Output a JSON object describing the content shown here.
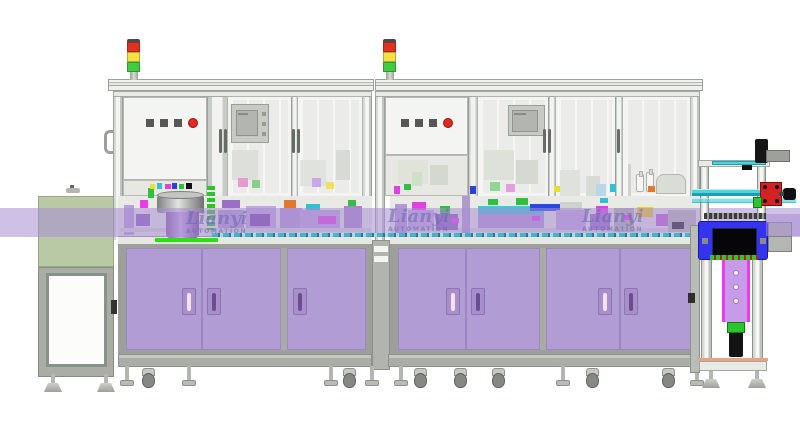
{
  "title": "Automated assembly line - CAD side view",
  "watermark": {
    "brand": "Lianyi",
    "sub": "AUTOMATION",
    "instances": [
      {
        "x": 186,
        "y": 210
      },
      {
        "x": 388,
        "y": 208
      },
      {
        "x": 582,
        "y": 208
      }
    ]
  },
  "signal_towers": {
    "positions": [
      127,
      383
    ],
    "segments": [
      "red",
      "yellow",
      "green"
    ]
  },
  "control_panels": [
    {
      "squares_x": [
        146,
        160,
        174
      ],
      "round_x": 188,
      "y": 119
    },
    {
      "squares_x": [
        401,
        415,
        429
      ],
      "round_x": 443,
      "y": 119
    }
  ],
  "colors": {
    "frame-mid": "#ced1cb",
    "panel": "#f4f5f2",
    "glass": "#ebece9",
    "table": "#e9eae5",
    "cabinet": "#b19cd3",
    "cabinet-seam": "#9d86c2",
    "cabinet-border": "#9d9f9a",
    "handle-dark": "#6b4e92",
    "handle-light": "#f2e3fa",
    "base": "#abaea7",
    "band": "rgba(168,140,210,0.55)",
    "green-box": "#b9c9a6",
    "body-gray": "#a9ada6",
    "door-white": "#fcfcfb",
    "tower-red": "#e0301e",
    "tower-yellow": "#f2e143",
    "tower-green": "#41cb41",
    "btn-red": "#e5271e",
    "btn-dark": "#575757",
    "hmi": "#c8cac5",
    "hmi-screen": "#b3b6b0",
    "blue": "#3434ee",
    "teal": "#4fd4da",
    "teal-dark": "#1b9fb4",
    "col-purple": "#c89be8",
    "magenta": "#ea3cea",
    "bright-green": "#2edf12",
    "red-unit": "#d32222",
    "wm": "rgba(100,100,170,0.52)"
  },
  "band_blocks": [
    [
      124,
      205,
      10,
      30,
      "#b9a0d8"
    ],
    [
      136,
      214,
      14,
      12,
      "#8f5fc0"
    ],
    [
      140,
      200,
      8,
      8,
      "#ea3cea"
    ],
    [
      148,
      188,
      6,
      10,
      "#30c040"
    ],
    [
      150,
      184,
      5,
      5,
      "#e8e030"
    ],
    [
      157,
      183,
      5,
      6,
      "#30c0d0"
    ],
    [
      165,
      184,
      6,
      5,
      "#e040e0"
    ],
    [
      172,
      183,
      5,
      6,
      "#3040e0"
    ],
    [
      179,
      184,
      5,
      5,
      "#30c040"
    ],
    [
      186,
      183,
      6,
      6,
      "#111111"
    ],
    [
      218,
      210,
      26,
      22,
      "#b49ad4"
    ],
    [
      222,
      200,
      18,
      8,
      "#9a6fc8"
    ],
    [
      232,
      150,
      26,
      30,
      "#dde0da"
    ],
    [
      238,
      178,
      10,
      9,
      "#e89ad0"
    ],
    [
      252,
      180,
      8,
      8,
      "#88d088"
    ],
    [
      246,
      206,
      30,
      26,
      "#c0a8e0"
    ],
    [
      250,
      214,
      20,
      12,
      "#7848a8"
    ],
    [
      280,
      208,
      22,
      24,
      "#b49ad4"
    ],
    [
      284,
      200,
      12,
      8,
      "#e07830"
    ],
    [
      300,
      160,
      26,
      26,
      "#e0e2dd"
    ],
    [
      336,
      150,
      14,
      30,
      "#d8dbd5"
    ],
    [
      312,
      178,
      9,
      9,
      "#c8a8e8"
    ],
    [
      326,
      182,
      8,
      7,
      "#f0e060"
    ],
    [
      300,
      210,
      40,
      20,
      "#bfa6de"
    ],
    [
      306,
      204,
      14,
      6,
      "#30c0d0"
    ],
    [
      318,
      216,
      18,
      8,
      "#e040e0"
    ],
    [
      344,
      206,
      18,
      26,
      "#a888cc"
    ],
    [
      348,
      200,
      8,
      6,
      "#30c040"
    ],
    [
      120,
      228,
      250,
      4,
      "#d8dad4"
    ],
    [
      390,
      228,
      310,
      4,
      "#d8dad4"
    ],
    [
      398,
      160,
      30,
      24,
      "#dfe3da"
    ],
    [
      430,
      165,
      18,
      20,
      "#d4d9cf"
    ],
    [
      412,
      172,
      10,
      14,
      "#cfe0c8"
    ],
    [
      394,
      186,
      6,
      8,
      "#e040e0"
    ],
    [
      404,
      184,
      7,
      6,
      "#30c040"
    ],
    [
      395,
      204,
      12,
      30,
      "#b49ad4"
    ],
    [
      408,
      210,
      26,
      20,
      "#c0a8e0"
    ],
    [
      412,
      202,
      14,
      8,
      "#e040e0"
    ],
    [
      436,
      214,
      22,
      16,
      "#8f5fc0"
    ],
    [
      440,
      206,
      10,
      8,
      "#30c040"
    ],
    [
      452,
      218,
      7,
      5,
      "#ea3cea"
    ],
    [
      462,
      196,
      8,
      40,
      "#b09ace"
    ],
    [
      470,
      186,
      6,
      8,
      "#3040e0"
    ],
    [
      484,
      150,
      30,
      30,
      "#dee0da"
    ],
    [
      516,
      160,
      22,
      24,
      "#d6d8d2"
    ],
    [
      490,
      182,
      10,
      9,
      "#90d890"
    ],
    [
      506,
      184,
      9,
      8,
      "#e0a0e0"
    ],
    [
      478,
      206,
      66,
      8,
      "#3ec8d8"
    ],
    [
      478,
      214,
      66,
      14,
      "#b49ad4"
    ],
    [
      488,
      199,
      10,
      6,
      "#30c040"
    ],
    [
      516,
      198,
      12,
      7,
      "#30c040"
    ],
    [
      530,
      204,
      32,
      7,
      "#2848e0"
    ],
    [
      532,
      216,
      8,
      5,
      "#ea3cea"
    ],
    [
      554,
      186,
      7,
      6,
      "#e8e030"
    ],
    [
      560,
      170,
      20,
      26,
      "#dfe1dc"
    ],
    [
      586,
      176,
      14,
      20,
      "#d8dad5"
    ],
    [
      596,
      184,
      10,
      12,
      "#b8d8e8"
    ],
    [
      556,
      210,
      30,
      20,
      "#c0a8e0"
    ],
    [
      560,
      202,
      22,
      8,
      "#cfd2cc"
    ],
    [
      590,
      214,
      20,
      16,
      "#9a6fc8"
    ],
    [
      596,
      206,
      12,
      8,
      "#e040e0"
    ],
    [
      600,
      198,
      8,
      5,
      "#30c0d0"
    ],
    [
      610,
      184,
      6,
      8,
      "#30c0d0"
    ],
    [
      614,
      208,
      20,
      24,
      "#b0b3ae"
    ],
    [
      624,
      215,
      7,
      5,
      "#ea3cea"
    ],
    [
      637,
      207,
      16,
      10,
      "#f0d020"
    ],
    [
      648,
      186,
      7,
      6,
      "#e07830"
    ],
    [
      656,
      214,
      12,
      12,
      "#c05fd0"
    ],
    [
      668,
      210,
      28,
      22,
      "#b7bab4"
    ],
    [
      672,
      222,
      12,
      7,
      "#1a1a1a"
    ],
    [
      628,
      164,
      3,
      32,
      "#d0d2cc"
    ]
  ],
  "feet": [
    {
      "x": 44,
      "y": 374,
      "t": "cone"
    },
    {
      "x": 97,
      "y": 374,
      "t": "cone"
    },
    {
      "x": 118,
      "y": 366,
      "t": "foot"
    },
    {
      "x": 140,
      "y": 366,
      "t": "caster"
    },
    {
      "x": 180,
      "y": 366,
      "t": "foot"
    },
    {
      "x": 322,
      "y": 366,
      "t": "foot"
    },
    {
      "x": 341,
      "y": 366,
      "t": "caster"
    },
    {
      "x": 363,
      "y": 366,
      "t": "foot"
    },
    {
      "x": 392,
      "y": 366,
      "t": "foot"
    },
    {
      "x": 412,
      "y": 366,
      "t": "caster"
    },
    {
      "x": 452,
      "y": 366,
      "t": "caster"
    },
    {
      "x": 490,
      "y": 366,
      "t": "caster"
    },
    {
      "x": 554,
      "y": 366,
      "t": "foot"
    },
    {
      "x": 584,
      "y": 366,
      "t": "caster"
    },
    {
      "x": 660,
      "y": 366,
      "t": "caster"
    },
    {
      "x": 688,
      "y": 366,
      "t": "foot"
    },
    {
      "x": 702,
      "y": 370,
      "t": "cone"
    },
    {
      "x": 748,
      "y": 370,
      "t": "cone"
    }
  ]
}
